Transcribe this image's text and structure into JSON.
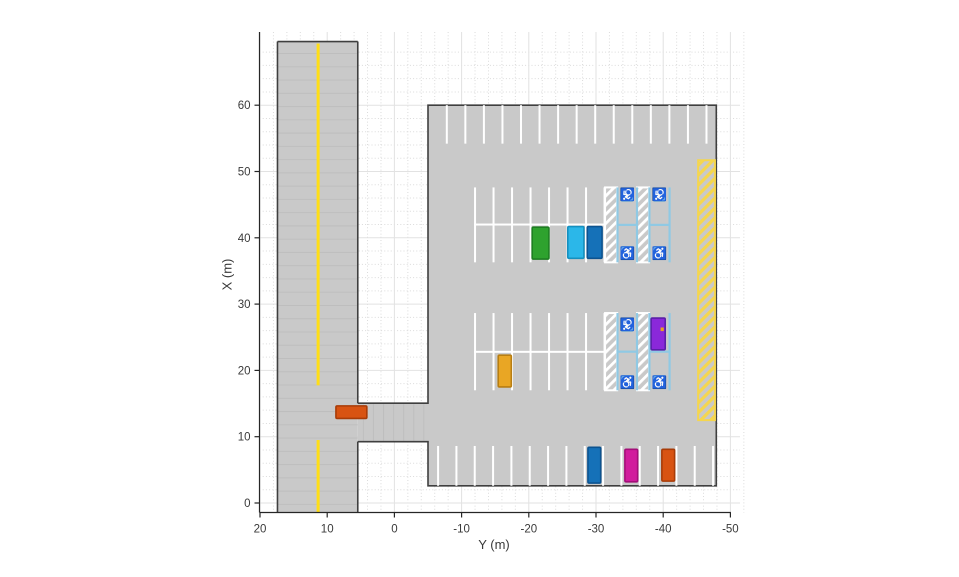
{
  "figure": {
    "width": 959,
    "height": 577,
    "background": "#FFFFFF"
  },
  "axes": {
    "xlabel": "Y (m)",
    "ylabel": "X (m)",
    "x_ticks": [
      20,
      10,
      0,
      -10,
      -20,
      -30,
      -40,
      -50
    ],
    "y_ticks": [
      0,
      10,
      20,
      30,
      40,
      50,
      60
    ],
    "x_minor_step": 2,
    "y_minor_step": 2,
    "colors": {
      "spine": "#262626",
      "tick_label": "#3a3a3a",
      "grid_major": "#e2e2e2",
      "grid_minor": "#dbdbdb"
    }
  },
  "chart_data": {
    "type": "driving-scenario",
    "title": "",
    "xlabel": "Y (m)",
    "ylabel": "X (m)",
    "x_axis_reversed": true,
    "xlim": [
      20,
      -52
    ],
    "ylim": [
      -1.5,
      71
    ],
    "surface_color": "#c9c9c9",
    "texture_color": "#bebebe",
    "line_marking_color": "#ffffff",
    "boundary_color": "#3f3f3f",
    "road": {
      "y_left": 17.4,
      "y_right": 5.45,
      "x_top": 69.6,
      "x_bottom": -1.5,
      "texture_spacing_m": 2,
      "lane_marking": {
        "y_center": 11.35,
        "color": "#ffde17",
        "width_m": 0.45,
        "segments_x": [
          [
            69.3,
            17.75
          ],
          [
            9.5,
            -1.5
          ]
        ]
      }
    },
    "entrance": {
      "y": [
        5.45,
        -5.0
      ],
      "x": [
        9.25,
        15.05
      ],
      "texture_spacing_m": 1.5
    },
    "parking_lot": {
      "y": [
        -5.0,
        -47.9
      ],
      "x": [
        2.6,
        60.0
      ]
    },
    "parking_rows": [
      {
        "name": "top-row",
        "lines_y_start": -7.8,
        "spacing": 2.76,
        "count": 15,
        "x": [
          54.2,
          60.0
        ]
      },
      {
        "name": "bottom-row",
        "lines_y_start": -6.5,
        "spacing": 2.728,
        "count": 16,
        "x": [
          2.6,
          8.6
        ]
      },
      {
        "name": "middle-upper-double-row",
        "lines_y_start": -12.0,
        "spacing": 2.753,
        "count": 8,
        "x": [
          36.3,
          47.6
        ],
        "separator_x": 42.0
      },
      {
        "name": "middle-lower-double-row",
        "lines_y_start": -12.0,
        "spacing": 2.753,
        "count": 8,
        "x": [
          17.0,
          28.65
        ],
        "separator_x": 22.8
      }
    ],
    "accessible_parking": {
      "line_color": "#8fc9e4",
      "icon_bg": "#4ba9d7",
      "icon_color": "#ffffff",
      "icon_glyph": "♿",
      "bands_x": [
        [
          36.3,
          47.6
        ],
        [
          17.0,
          28.65
        ]
      ],
      "no_parking_hatches_y": [
        [
          -31.35,
          -33.15
        ],
        [
          -36.1,
          -37.9
        ]
      ],
      "spot_columns_y": [
        [
          -33.2,
          -36.1
        ],
        [
          -37.95,
          -40.95
        ]
      ],
      "icons": [
        {
          "y": -34.65,
          "x": 46.5,
          "rotated": true
        },
        {
          "y": -39.45,
          "x": 46.5,
          "rotated": true
        },
        {
          "y": -34.65,
          "x": 37.7,
          "rotated": false
        },
        {
          "y": -39.45,
          "x": 37.7,
          "rotated": false
        },
        {
          "y": -34.65,
          "x": 26.9,
          "rotated": true
        },
        {
          "y": -34.65,
          "x": 18.25,
          "rotated": false
        },
        {
          "y": -39.45,
          "x": 18.25,
          "rotated": false
        }
      ]
    },
    "no_parking_zone": {
      "y": [
        -45.2,
        -47.7
      ],
      "x": [
        12.5,
        51.7
      ],
      "color": "#f5d64e"
    },
    "vehicles": [
      {
        "name": "green-car",
        "y": [
          -20.5,
          -23.0
        ],
        "x": [
          36.8,
          41.6
        ],
        "fill": "#2ea22e",
        "stroke": "#1e7e22"
      },
      {
        "name": "cyan-car",
        "y": [
          -25.8,
          -28.2
        ],
        "x": [
          36.9,
          41.7
        ],
        "fill": "#2bb7e9",
        "stroke": "#1590bf"
      },
      {
        "name": "blue-car-middle",
        "y": [
          -28.7,
          -30.9
        ],
        "x": [
          36.9,
          41.7
        ],
        "fill": "#1571b8",
        "stroke": "#0c5390"
      },
      {
        "name": "amber-car",
        "y": [
          -15.45,
          -17.4
        ],
        "x": [
          17.5,
          22.3
        ],
        "fill": "#e9a624",
        "stroke": "#b87e12"
      },
      {
        "name": "purple-car",
        "y": [
          -38.2,
          -40.3
        ],
        "x": [
          23.1,
          27.9
        ],
        "fill": "#8a28da",
        "stroke": "#5a1fa8",
        "marker": {
          "y": -39.85,
          "x": 26.2,
          "color": "#e8a11f"
        }
      },
      {
        "name": "orange-car-entrance",
        "y": [
          4.1,
          8.7
        ],
        "x": [
          12.75,
          14.65
        ],
        "fill": "#d85312",
        "stroke": "#a83c08"
      },
      {
        "name": "blue-car-bottom",
        "y": [
          -28.8,
          -30.7
        ],
        "x": [
          3.0,
          8.4
        ],
        "fill": "#1571b8",
        "stroke": "#0c5390"
      },
      {
        "name": "magenta-car",
        "y": [
          -34.3,
          -36.2
        ],
        "x": [
          3.2,
          8.1
        ],
        "fill": "#d11c9d",
        "stroke": "#a40f79"
      },
      {
        "name": "orange-car-bottom",
        "y": [
          -39.8,
          -41.7
        ],
        "x": [
          3.3,
          8.1
        ],
        "fill": "#d85312",
        "stroke": "#a83c08"
      }
    ]
  }
}
